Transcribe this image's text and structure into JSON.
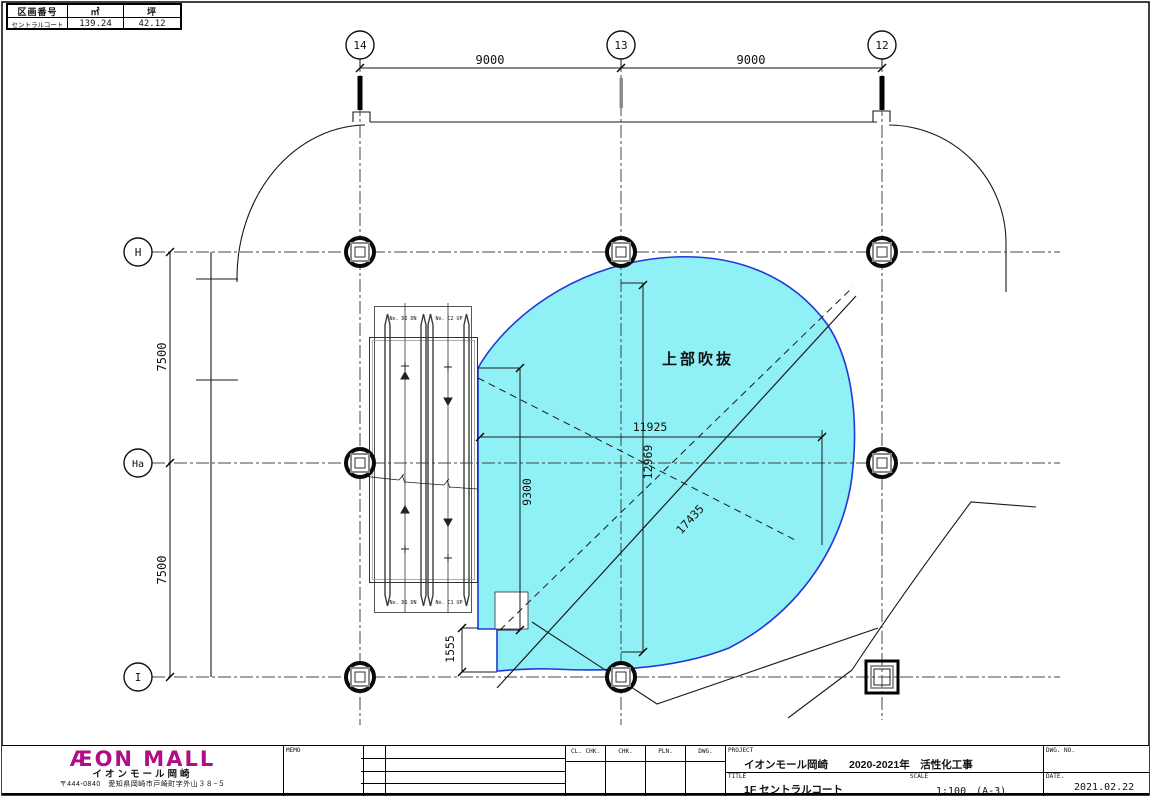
{
  "area_table": {
    "headers": [
      "区画番号",
      "㎡",
      "坪"
    ],
    "name": "セントラルコート",
    "sqm": "139.24",
    "tsubo": "42.12"
  },
  "grid": {
    "top": [
      "14",
      "13",
      "12"
    ],
    "left": [
      "H",
      "Ha",
      "I"
    ]
  },
  "dims": {
    "span_left": "9000",
    "span_right": "9000",
    "h_upper": "7500",
    "h_lower": "7500",
    "void_w": "11925",
    "void_h": "12969",
    "esc_h": "9300",
    "diag": "17435",
    "step": "1555"
  },
  "plan": {
    "void_label": "上部吹抜",
    "escalators": {
      "top_left": "No. D2 DN",
      "top_right": "No. C2 UP",
      "bottom_left": "No. D1 DN",
      "bottom_right": "No. C1 UP"
    }
  },
  "company": {
    "logo": "ÆON MALL",
    "name": "イオンモール岡崎",
    "address": "〒444-0840　愛知県岡崎市戸崎町字外山３８−５"
  },
  "titleblock": {
    "memo_label": "MEMO",
    "sign_headers": [
      "CL. CHK.",
      "CHK.",
      "PLN.",
      "DWG."
    ],
    "project_label": "PROJECT",
    "project": "イオンモール岡崎　　2020-2021年　活性化工事",
    "title_label": "TITLE",
    "title": "1F セントラルコート",
    "scale_label": "SCALE",
    "scale": "1:100　(A-3)",
    "date_label": "DATE.",
    "date": "2021.02.22",
    "dwg_no_label": "DWG. NO."
  },
  "colors": {
    "void_fill": "#8FF0F6",
    "void_border": "#2238D8",
    "logo_magenta": "#B00D86"
  }
}
